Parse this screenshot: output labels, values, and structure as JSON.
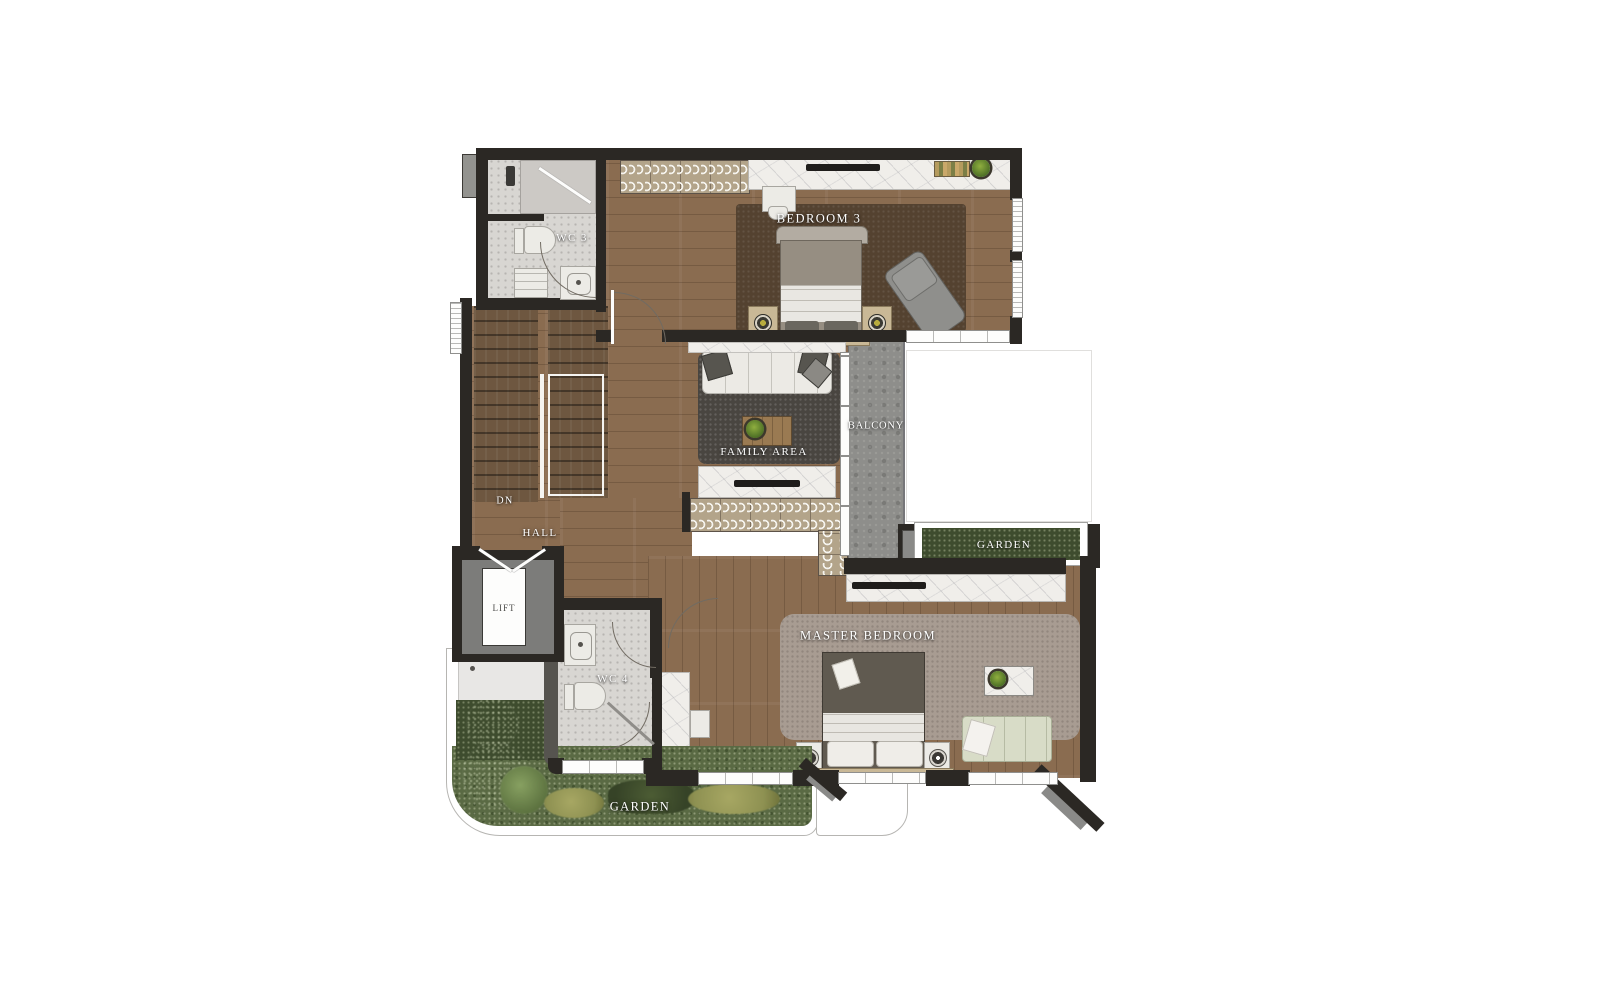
{
  "plan": {
    "type": "residential floor plan (upper level)",
    "labels": {
      "bedroom3": "BEDROOM 3",
      "wc3": "WC 3",
      "family_area": "FAMILY AREA",
      "balcony": "BALCONY",
      "garden_right": "GARDEN",
      "master_bedroom": "MASTER BEDROOM",
      "lift": "LIFT",
      "wc4": "WC 4",
      "hall": "HALL",
      "stairs_direction": "DN",
      "garden_bottom": "GARDEN"
    },
    "colors": {
      "wall": "#2b2824",
      "wood": "#8a6c50",
      "stairs": "#6e5740",
      "marble": "#f0eeea",
      "wc": "#d8d6d2",
      "rug3": "#544230",
      "rugfam": "#494540",
      "rugm": "#a89c92",
      "balc": "#8e8e8b",
      "gdark": "#3e4c2e",
      "grass": "#5a6a44",
      "bushy": "#8e9152",
      "lift": "#7c7c7a",
      "ward": "#b3a48a",
      "daybed": "#d8dcc7",
      "sofa": "#eceae5",
      "tv": "#1f1d1b",
      "bench": "#c9b896"
    }
  }
}
